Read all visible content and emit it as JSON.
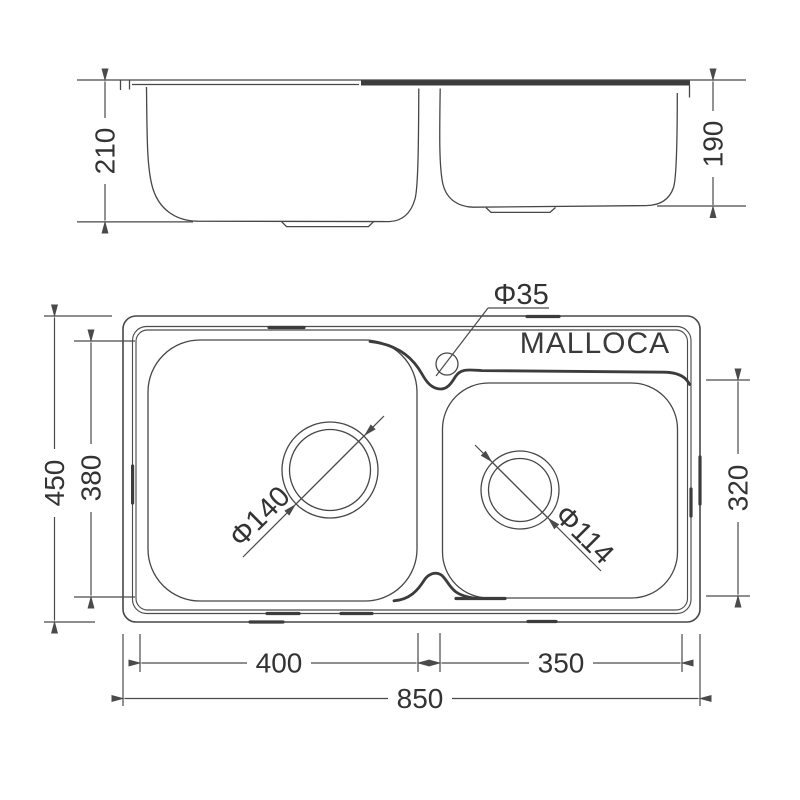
{
  "diagram": {
    "brand_label": "MALLOCA",
    "side_view": {
      "left_bowl_depth": "210",
      "right_bowl_depth": "190"
    },
    "plan_view": {
      "overall_width": "450",
      "left_bowl_inner_width": "380",
      "right_bowl_inner_width": "320",
      "faucet_hole_diameter": "Φ35",
      "left_drain_diameter": "Φ140",
      "right_drain_diameter": "Φ114",
      "left_bowl_length": "400",
      "right_bowl_length": "350",
      "overall_length": "850"
    },
    "colors": {
      "line": "#474747",
      "thick_line": "#3c3c3c",
      "text": "#333333",
      "background": "#ffffff"
    }
  }
}
